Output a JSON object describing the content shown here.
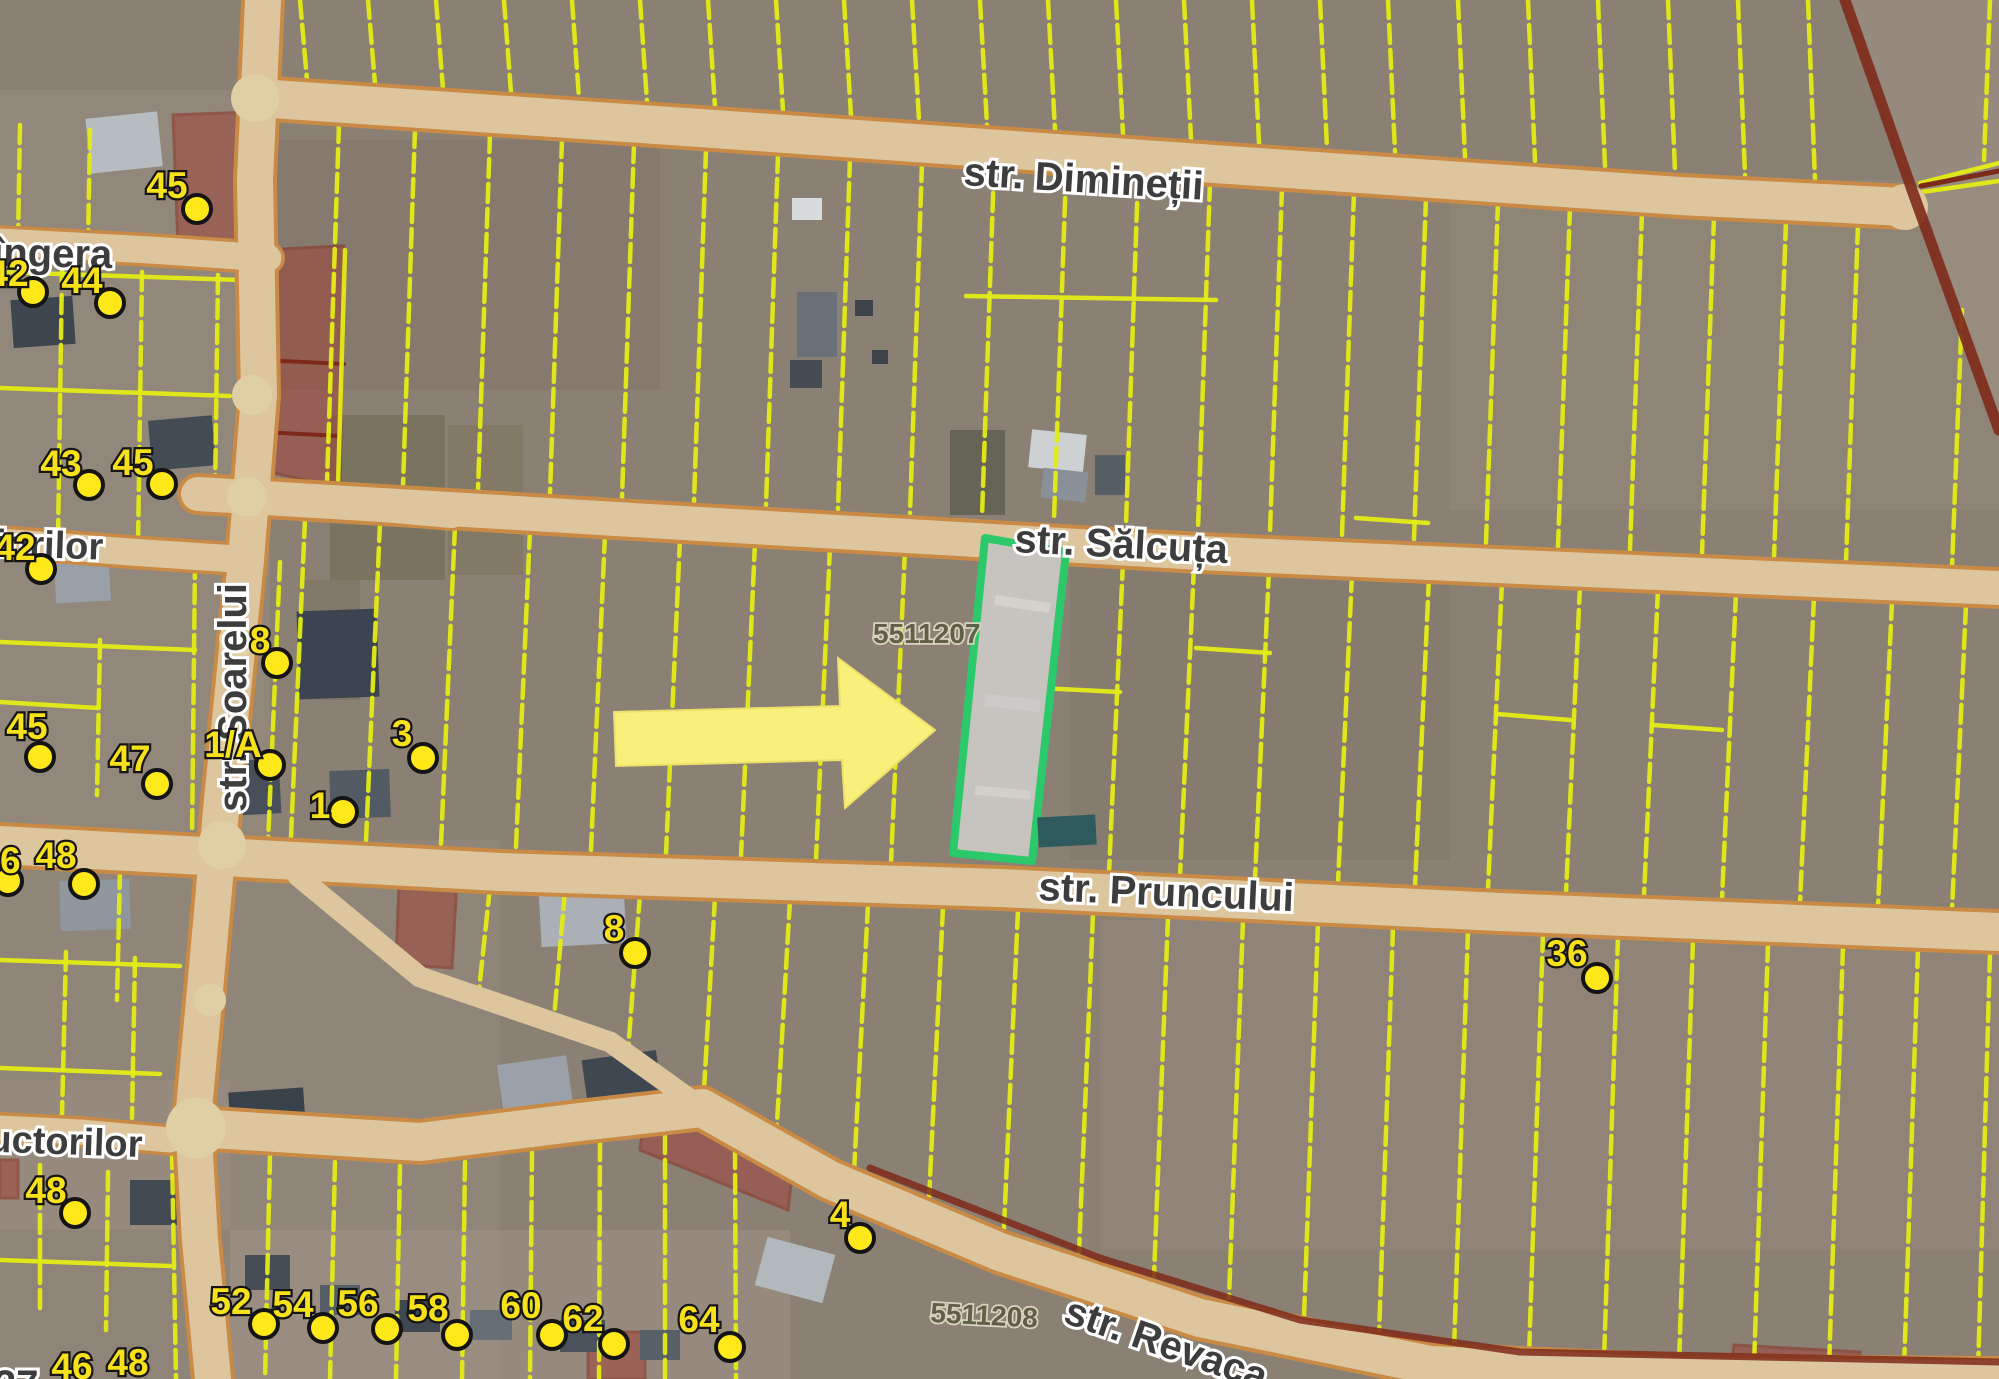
{
  "map": {
    "type": "cadastral-satellite-map",
    "streets": {
      "diminetii": {
        "name": "str. Dimineții"
      },
      "salcuta": {
        "name": "str. Sălcuța"
      },
      "pruncului": {
        "name": "str. Pruncului"
      },
      "revaca": {
        "name": "str. Revaca"
      },
      "soarelui": {
        "name": "str. Soarelui"
      },
      "viorilor_partial": {
        "name": "viorilor"
      },
      "singera_partial": {
        "name": "îngera"
      },
      "constructorilor_partial": {
        "name": "uctorilor"
      },
      "corner_partial": {
        "name": "37"
      }
    },
    "cadastral": {
      "sector_a": "5511207",
      "sector_b": "5511208"
    },
    "highlighted_parcel": {
      "zone": "5511207",
      "outline_color": "#2bc96a",
      "fill_color": "#c7c3bf"
    },
    "arrow_color": "#f9f07c",
    "parcel_line_color": "#e4ec16",
    "road_fill_color": "#ddc69e",
    "road_border_color": "#c98a45",
    "restricted_zone_color": "#a0443a",
    "house_numbers": [
      {
        "n": "45",
        "x": 167,
        "y": 198,
        "dx": 197,
        "dy": 209
      },
      {
        "n": "42",
        "x": 8,
        "y": 286,
        "dx": 33,
        "dy": 292
      },
      {
        "n": "44",
        "x": 82,
        "y": 293,
        "dx": 110,
        "dy": 303
      },
      {
        "n": "43",
        "x": 61,
        "y": 476,
        "dx": 89,
        "dy": 485
      },
      {
        "n": "45",
        "x": 133,
        "y": 475,
        "dx": 162,
        "dy": 484
      },
      {
        "n": "42",
        "x": 15,
        "y": 560,
        "dx": 41,
        "dy": 569
      },
      {
        "n": "8",
        "x": 260,
        "y": 653,
        "dx": 277,
        "dy": 663
      },
      {
        "n": "45",
        "x": 27,
        "y": 739,
        "dx": 40,
        "dy": 757
      },
      {
        "n": "47",
        "x": 130,
        "y": 771,
        "dx": 157,
        "dy": 784
      },
      {
        "n": "1/A",
        "x": 233,
        "y": 757,
        "dx": 270,
        "dy": 765
      },
      {
        "n": "3",
        "x": 402,
        "y": 746,
        "dx": 423,
        "dy": 758
      },
      {
        "n": "1",
        "x": 320,
        "y": 818,
        "dx": 343,
        "dy": 812
      },
      {
        "n": "46",
        "x": 0,
        "y": 873,
        "dx": 8,
        "dy": 881
      },
      {
        "n": "48",
        "x": 56,
        "y": 868,
        "dx": 84,
        "dy": 884
      },
      {
        "n": "48",
        "x": 46,
        "y": 1203,
        "dx": 75,
        "dy": 1213
      },
      {
        "n": "8",
        "x": 614,
        "y": 941,
        "dx": 635,
        "dy": 953
      },
      {
        "n": "36",
        "x": 1567,
        "y": 966,
        "dx": 1597,
        "dy": 978
      },
      {
        "n": "4",
        "x": 840,
        "y": 1227,
        "dx": 860,
        "dy": 1238
      },
      {
        "n": "52",
        "x": 231,
        "y": 1314,
        "dx": 264,
        "dy": 1324
      },
      {
        "n": "54",
        "x": 293,
        "y": 1317,
        "dx": 323,
        "dy": 1328
      },
      {
        "n": "56",
        "x": 358,
        "y": 1316,
        "dx": 387,
        "dy": 1329
      },
      {
        "n": "58",
        "x": 428,
        "y": 1321,
        "dx": 457,
        "dy": 1335
      },
      {
        "n": "60",
        "x": 521,
        "y": 1318,
        "dx": 552,
        "dy": 1335
      },
      {
        "n": "62",
        "x": 583,
        "y": 1331,
        "dx": 614,
        "dy": 1344
      },
      {
        "n": "64",
        "x": 699,
        "y": 1332,
        "dx": 730,
        "dy": 1347
      },
      {
        "n": "46",
        "x": 72,
        "y": 1379,
        "dx": null,
        "dy": null
      },
      {
        "n": "48",
        "x": 128,
        "y": 1375,
        "dx": null,
        "dy": null
      }
    ]
  }
}
